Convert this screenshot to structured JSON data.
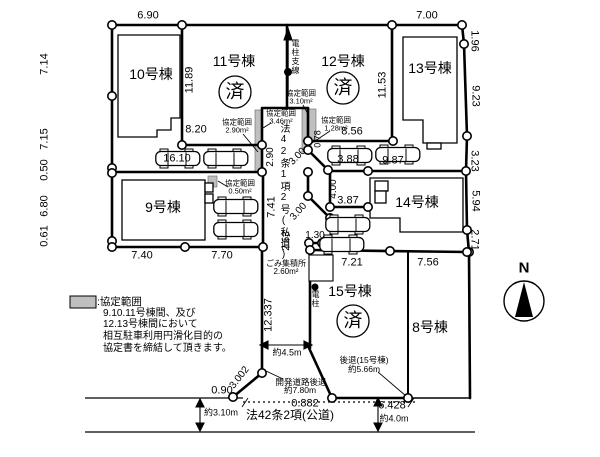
{
  "colors": {
    "line": "#000000",
    "background": "#ffffff",
    "agreement_fill": "#bfbfbf"
  },
  "labels": [
    {
      "name": "dim-top-6-90",
      "text": "6.90",
      "x": 148,
      "y": 16,
      "size": 11
    },
    {
      "name": "dim-top-7-00",
      "text": "7.00",
      "x": 427,
      "y": 16,
      "size": 11
    },
    {
      "name": "dim-left-7-14",
      "text": "7.14",
      "x": 45,
      "y": 64,
      "rot": -90,
      "size": 11
    },
    {
      "name": "dim-left-7-15",
      "text": "7.15",
      "x": 45,
      "y": 139,
      "rot": -90,
      "size": 11
    },
    {
      "name": "dim-left-0-50",
      "text": "0.50",
      "x": 45,
      "y": 170,
      "rot": -90,
      "size": 11
    },
    {
      "name": "dim-left-6-80",
      "text": "6.80",
      "x": 45,
      "y": 206,
      "rot": -90,
      "size": 11
    },
    {
      "name": "dim-left-0-61",
      "text": "0.61",
      "x": 45,
      "y": 236,
      "rot": -90,
      "size": 11
    },
    {
      "name": "dim-11-89",
      "text": "11.89",
      "x": 190,
      "y": 80,
      "rot": -90,
      "size": 11
    },
    {
      "name": "dim-8-20",
      "text": "8.20",
      "x": 196,
      "y": 130,
      "size": 11
    },
    {
      "name": "dim-16-10",
      "text": "16.10",
      "x": 177,
      "y": 159,
      "size": 11
    },
    {
      "name": "dim-2-90",
      "text": "2.90",
      "x": 271,
      "y": 157,
      "rot": -90,
      "size": 10
    },
    {
      "name": "dim-7-41",
      "text": "7.41",
      "x": 272,
      "y": 207,
      "rot": -90,
      "size": 11
    },
    {
      "name": "dim-2-53",
      "text": "2.53",
      "x": 287,
      "y": 241,
      "rot": -90,
      "size": 10
    },
    {
      "name": "dim-12-337",
      "text": "12.337",
      "x": 269,
      "y": 315,
      "rot": -90,
      "size": 11
    },
    {
      "name": "dim-11-53",
      "text": "11.53",
      "x": 383,
      "y": 85,
      "rot": -90,
      "size": 11
    },
    {
      "name": "dim-8-56",
      "text": "8.56",
      "x": 352,
      "y": 132,
      "size": 11
    },
    {
      "name": "dim-0-78",
      "text": "0.78",
      "x": 318,
      "y": 139,
      "rot": -90,
      "size": 9
    },
    {
      "name": "dim-3-00-upper",
      "text": "3.00",
      "x": 298,
      "y": 157,
      "rot": -46,
      "size": 10
    },
    {
      "name": "dim-3-00-lower",
      "text": "3.00",
      "x": 299,
      "y": 212,
      "rot": -48,
      "size": 10
    },
    {
      "name": "dim-3-88",
      "text": "3.88",
      "x": 348,
      "y": 160,
      "size": 11
    },
    {
      "name": "dim-9-87",
      "text": "9.87",
      "x": 393,
      "y": 161,
      "size": 11
    },
    {
      "name": "dim-4-00",
      "text": "4.00",
      "x": 334,
      "y": 189,
      "rot": -90,
      "size": 10
    },
    {
      "name": "dim-3-87",
      "text": "3.87",
      "x": 348,
      "y": 201,
      "size": 11
    },
    {
      "name": "dim-1-30",
      "text": "1.30",
      "x": 315,
      "y": 236,
      "size": 10
    },
    {
      "name": "dim-7-40",
      "text": "7.40",
      "x": 142,
      "y": 256,
      "size": 11
    },
    {
      "name": "dim-7-70",
      "text": "7.70",
      "x": 222,
      "y": 256,
      "size": 11
    },
    {
      "name": "dim-7-21",
      "text": "7.21",
      "x": 352,
      "y": 263,
      "size": 11
    },
    {
      "name": "dim-7-56",
      "text": "7.56",
      "x": 428,
      "y": 263,
      "size": 11
    },
    {
      "name": "dim-right-1-96",
      "text": "1.96",
      "x": 474,
      "y": 41,
      "rot": 90,
      "size": 11
    },
    {
      "name": "dim-right-9-23",
      "text": "9.23",
      "x": 475,
      "y": 96,
      "rot": 90,
      "size": 11
    },
    {
      "name": "dim-right-3-23",
      "text": "3.23",
      "x": 474,
      "y": 161,
      "rot": 90,
      "size": 11
    },
    {
      "name": "dim-right-5-94",
      "text": "5.94",
      "x": 475,
      "y": 201,
      "rot": 90,
      "size": 11
    },
    {
      "name": "dim-right-2-71",
      "text": "2.71",
      "x": 474,
      "y": 240,
      "rot": 90,
      "size": 11
    },
    {
      "name": "dim-3-002",
      "text": "3.002",
      "x": 240,
      "y": 378,
      "rot": -52,
      "size": 10
    },
    {
      "name": "dim-0-90",
      "text": "0.90",
      "x": 222,
      "y": 391,
      "size": 11
    },
    {
      "name": "dim-0-882",
      "text": "0.882",
      "x": 305,
      "y": 404,
      "size": 11
    },
    {
      "name": "dim-6-428",
      "text": "6.428",
      "x": 392,
      "y": 406,
      "size": 11
    },
    {
      "name": "dim-approx-4-0m",
      "text": "約4.0m",
      "x": 394,
      "y": 419,
      "size": 9
    },
    {
      "name": "dim-approx-3-10m",
      "text": "約3.10m",
      "x": 221,
      "y": 413,
      "size": 9
    },
    {
      "name": "dim-approx-4-5m",
      "text": "約4.5m",
      "x": 287,
      "y": 353,
      "size": 9
    },
    {
      "name": "lot-label-10",
      "text": "10号棟",
      "x": 151,
      "y": 74,
      "size": 14
    },
    {
      "name": "lot-label-11",
      "text": "11号棟",
      "x": 234,
      "y": 61,
      "size": 14
    },
    {
      "name": "lot-label-12",
      "text": "12号棟",
      "x": 343,
      "y": 61,
      "size": 14
    },
    {
      "name": "lot-label-13",
      "text": "13号棟",
      "x": 430,
      "y": 68,
      "size": 14
    },
    {
      "name": "lot-label-9",
      "text": "9号棟",
      "x": 163,
      "y": 207,
      "size": 14
    },
    {
      "name": "lot-label-14",
      "text": "14号棟",
      "x": 417,
      "y": 202,
      "size": 14
    },
    {
      "name": "lot-label-15",
      "text": "15号棟",
      "x": 350,
      "y": 291,
      "size": 14
    },
    {
      "name": "lot-label-8",
      "text": "8号棟",
      "x": 430,
      "y": 327,
      "size": 14
    },
    {
      "name": "sold-stamp-11",
      "text": "済",
      "x": 235,
      "y": 92,
      "size": 19
    },
    {
      "name": "sold-stamp-12",
      "text": "済",
      "x": 343,
      "y": 88,
      "size": 19
    },
    {
      "name": "sold-stamp-15",
      "text": "済",
      "x": 353,
      "y": 321,
      "size": 19
    },
    {
      "name": "agreement-290-line1",
      "text": "協定範囲",
      "x": 237,
      "y": 122,
      "size": 7.5
    },
    {
      "name": "agreement-290-line2",
      "text": "2.90m²",
      "x": 237,
      "y": 130,
      "size": 7.5
    },
    {
      "name": "agreement-346-line1",
      "text": "協定範囲",
      "x": 281,
      "y": 113,
      "size": 7.5
    },
    {
      "name": "agreement-346-line2",
      "text": "3.46m²",
      "x": 281,
      "y": 121,
      "size": 7.5
    },
    {
      "name": "agreement-310-line1",
      "text": "協定範囲",
      "x": 301,
      "y": 93,
      "size": 7.5
    },
    {
      "name": "agreement-310-line2",
      "text": "3.10m²",
      "x": 301,
      "y": 101,
      "size": 7.5
    },
    {
      "name": "agreement-128-line1",
      "text": "協定範囲",
      "x": 336,
      "y": 120,
      "size": 7.5
    },
    {
      "name": "agreement-128-line2",
      "text": "1.28m²",
      "x": 336,
      "y": 128,
      "size": 7.5
    },
    {
      "name": "agreement-050-line1",
      "text": "協定範囲",
      "x": 240,
      "y": 183,
      "size": 7.5
    },
    {
      "name": "agreement-050-line2",
      "text": "0.50m²",
      "x": 240,
      "y": 191,
      "size": 7.5
    },
    {
      "name": "trash-area-line1",
      "text": "ごみ集積所",
      "x": 286,
      "y": 264,
      "size": 8
    },
    {
      "name": "trash-area-line2",
      "text": "2.60m²",
      "x": 286,
      "y": 272,
      "size": 8
    },
    {
      "name": "setback-15-line1",
      "text": "後退(15号棟)",
      "x": 364,
      "y": 360,
      "size": 8.5
    },
    {
      "name": "setback-15-line2",
      "text": "約5.66m",
      "x": 364,
      "y": 369,
      "size": 8.5
    },
    {
      "name": "dev-road-setback-line1",
      "text": "開発道路後退",
      "x": 301,
      "y": 382,
      "size": 8.5
    },
    {
      "name": "dev-road-setback-line2",
      "text": "約7.80m",
      "x": 300,
      "y": 390,
      "size": 8.5
    },
    {
      "name": "pole-guy-wire-label",
      "text": "電柱支線",
      "x": 295,
      "y": 57,
      "size": 8,
      "vert": true
    },
    {
      "name": "private-road-label",
      "text": "法42条1項2号(私道)",
      "x": 283,
      "y": 192,
      "size": 10,
      "vert": true
    },
    {
      "name": "utility-pole-label",
      "text": "電柱",
      "x": 315,
      "y": 299,
      "size": 8,
      "vert": true
    },
    {
      "name": "public-road-label",
      "text": "法42条2項(公道)",
      "x": 290,
      "y": 415,
      "size": 12
    },
    {
      "name": "compass-n",
      "text": "N",
      "x": 524,
      "y": 268,
      "size": 15,
      "bold": true
    },
    {
      "name": "legend-title",
      "text": ":協定範囲",
      "x": 97,
      "y": 302,
      "size": 10.5,
      "align": "left"
    },
    {
      "name": "legend-line-1",
      "text": "9.10.11号棟間、及び",
      "x": 103,
      "y": 314,
      "size": 10,
      "align": "left"
    },
    {
      "name": "legend-line-2",
      "text": "12.13号棟間において",
      "x": 103,
      "y": 325,
      "size": 10,
      "align": "left"
    },
    {
      "name": "legend-line-3",
      "text": "相互駐車利用円滑化目的の",
      "x": 103,
      "y": 337,
      "size": 10,
      "align": "left"
    },
    {
      "name": "legend-line-4",
      "text": "協定書を締結して頂きます。",
      "x": 103,
      "y": 349,
      "size": 10,
      "align": "left"
    }
  ]
}
